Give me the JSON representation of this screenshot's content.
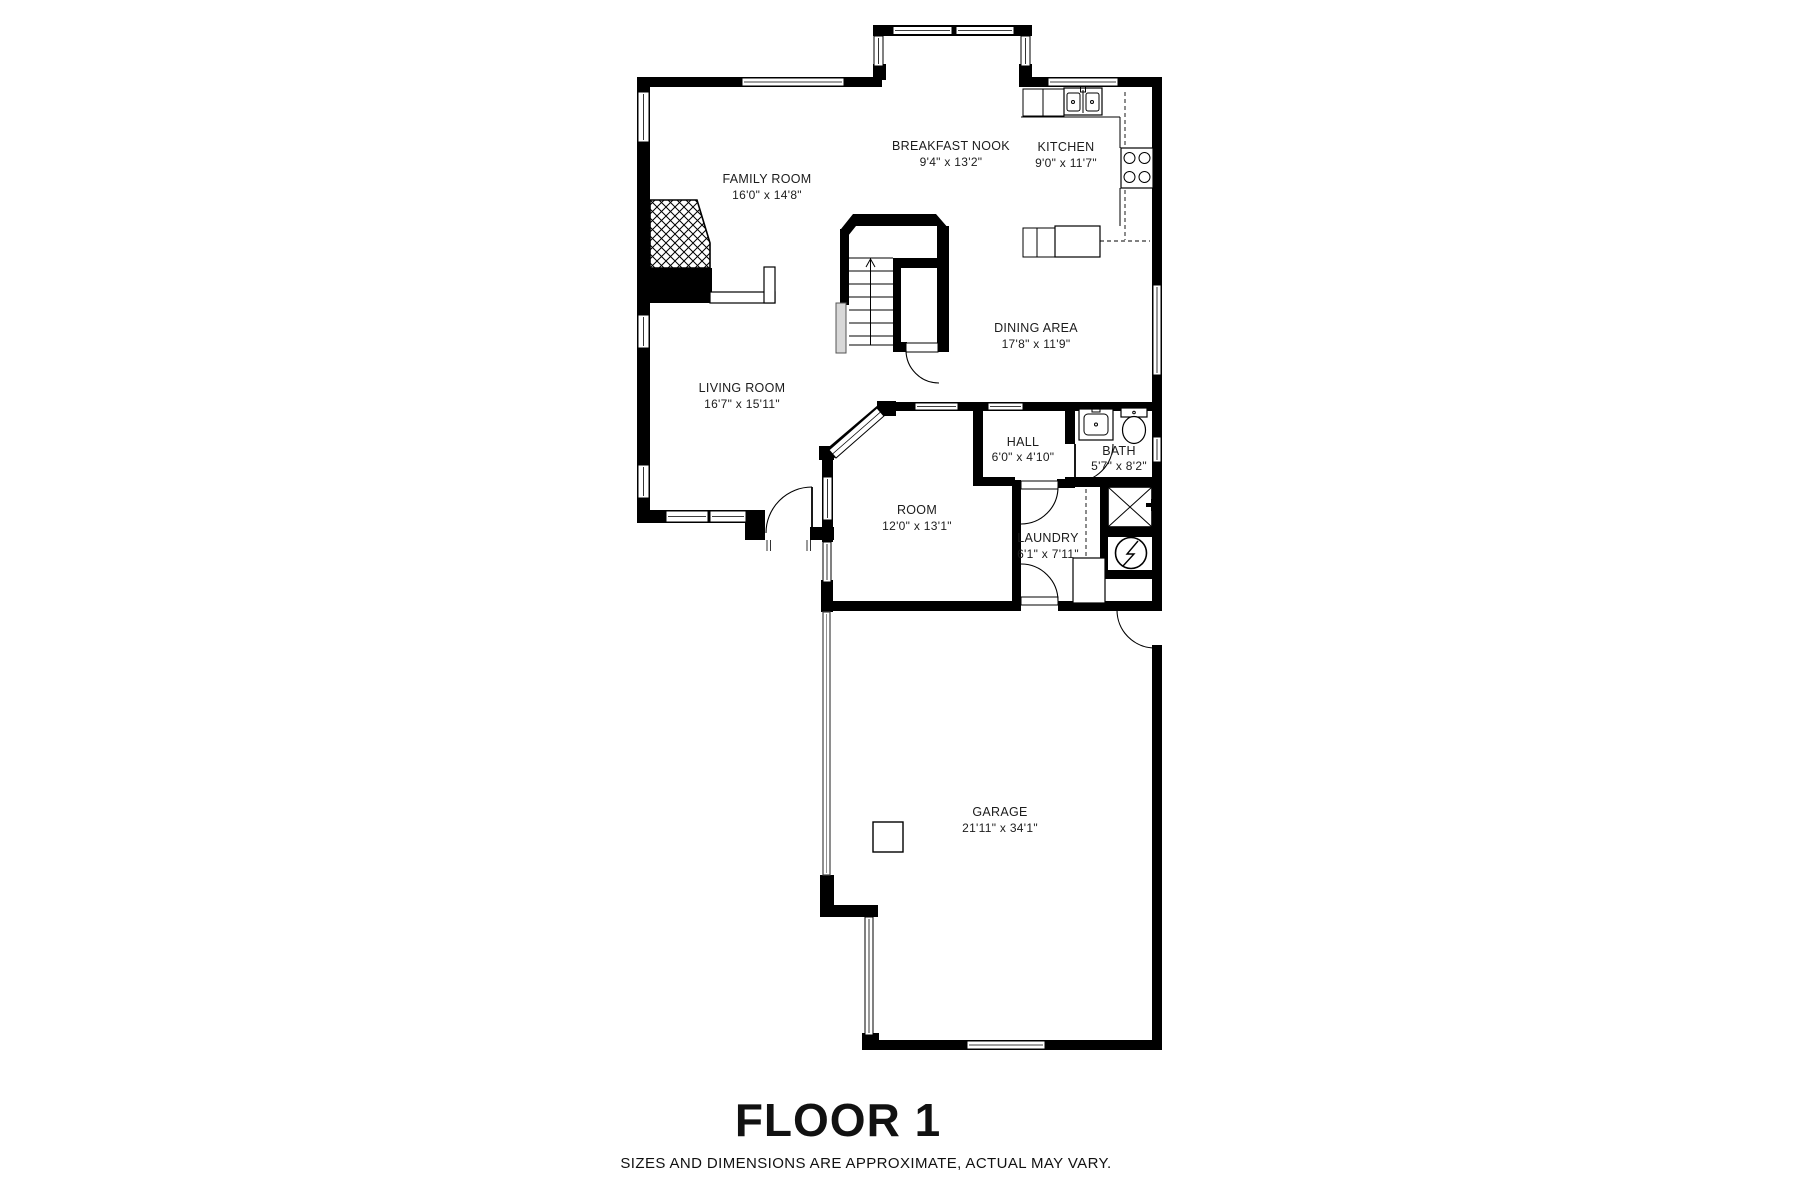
{
  "page": {
    "title": "FLOOR 1",
    "disclaimer": "SIZES AND DIMENSIONS ARE APPROXIMATE, ACTUAL MAY VARY."
  },
  "rooms": {
    "family_room": {
      "name": "FAMILY ROOM",
      "dims": "16'0\" x 14'8\""
    },
    "breakfast_nook": {
      "name": "BREAKFAST NOOK",
      "dims": "9'4\" x 13'2\""
    },
    "kitchen": {
      "name": "KITCHEN",
      "dims": "9'0\" x 11'7\""
    },
    "dining_area": {
      "name": "DINING AREA",
      "dims": "17'8\" x 11'9\""
    },
    "living_room": {
      "name": "LIVING ROOM",
      "dims": "16'7\" x 15'11\""
    },
    "hall": {
      "name": "HALL",
      "dims": "6'0\" x 4'10\""
    },
    "bath": {
      "name": "BATH",
      "dims": "5'7\" x 8'2\""
    },
    "room": {
      "name": "ROOM",
      "dims": "12'0\" x 13'1\""
    },
    "laundry": {
      "name": "LAUNDRY",
      "dims": "6'1\" x 7'11\""
    },
    "garage": {
      "name": "GARAGE",
      "dims": "21'11\" x 34'1\""
    }
  },
  "colors": {
    "wall": "#000000",
    "background": "#ffffff",
    "label": "#1c1c1c"
  }
}
